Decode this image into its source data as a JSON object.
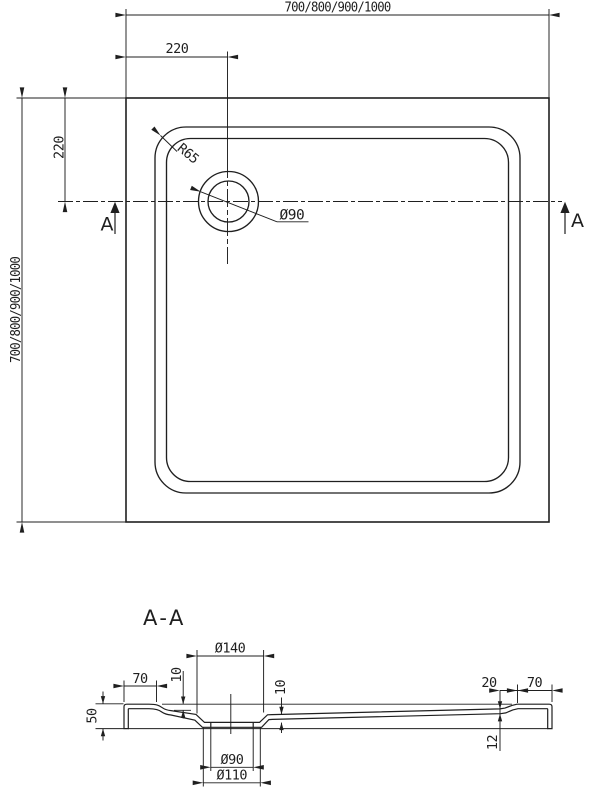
{
  "plan": {
    "dim_width": "700/800/900/1000",
    "dim_height": "700/800/900/1000",
    "dim_drain_offset_h": "220",
    "dim_drain_offset_v": "220",
    "label_corner_radius": "R65",
    "label_drain_diameter": "Ø90",
    "cut_label_left": "A",
    "cut_label_right": "A"
  },
  "section": {
    "title": "A-A",
    "dim_recess_diameter": "Ø140",
    "dim_left_edge_width": "70",
    "dim_right_edge_width": "70",
    "dim_right_edge_inner": "20",
    "dim_rim_height": "10",
    "dim_recess_depth": "10",
    "dim_total_height": "50",
    "dim_floor_thickness": "12",
    "dim_drain_hole": "Ø90",
    "dim_drain_outer": "Ø110"
  }
}
